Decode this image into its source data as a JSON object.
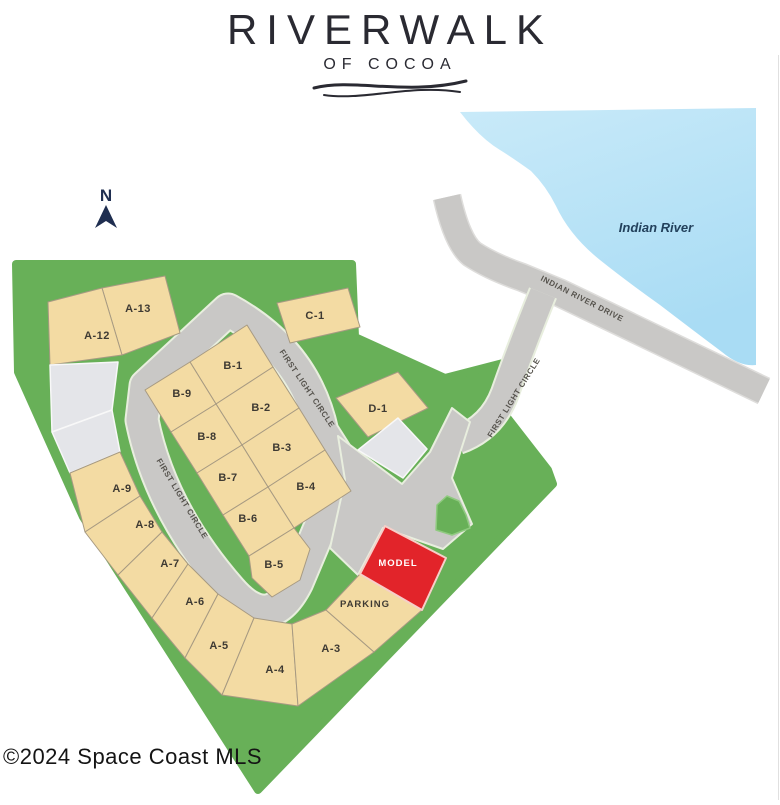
{
  "header": {
    "title": "RIVERWALK",
    "subtitle": "OF COCOA"
  },
  "compass": {
    "label": "N",
    "x": 106,
    "y": 201,
    "color": "#1f2e50"
  },
  "copyright": {
    "text": "©2024 Space Coast MLS"
  },
  "colors": {
    "water": "#a9dcf4",
    "water_light": "#c9eaf9",
    "green": "#68b058",
    "green_edge": "#8fca7f",
    "road": "#c9c8c6",
    "road_edge": "#e8eede",
    "ird_edge": "#dedddb",
    "lot_available": "#f3dba3",
    "lot_border": "#a79a82",
    "lot_unavailable": "#e4e5e9",
    "lot_unavailable_border": "#f8f8f8",
    "lot_model": "#e2242a",
    "lot_model_border": "#f6cfc9",
    "label_dark": "#3e3a33",
    "label_road": "#55524c",
    "label_water": "#23415c",
    "label_model": "#ffffff"
  },
  "water": {
    "label": "Indian River",
    "label_x": 656,
    "label_y": 232,
    "path": "M460,112 L756,108 L756,365 Q740,367 722,352 Q690,328 660,305 Q625,280 600,260 Q570,236 556,206 Q546,186 531,171 Q513,158 500,150 Q480,138 460,112 Z"
  },
  "site": {
    "points": [
      [
        16,
        264
      ],
      [
        352,
        264
      ],
      [
        355,
        337
      ],
      [
        445,
        378
      ],
      [
        503,
        363
      ],
      [
        492,
        398
      ],
      [
        548,
        470
      ],
      [
        553,
        484
      ],
      [
        258,
        790
      ],
      [
        83,
        517
      ],
      [
        18,
        372
      ]
    ],
    "tab_points": [
      [
        436,
        530
      ],
      [
        437,
        505
      ],
      [
        447,
        496
      ],
      [
        459,
        501
      ],
      [
        466,
        515
      ],
      [
        470,
        528
      ],
      [
        452,
        535
      ]
    ]
  },
  "roads": {
    "indian_river_drive": {
      "name": "INDIAN RIVER DRIVE",
      "path": "M447,197 Q457,242 472,254 Q492,267 521,277 L560,293 L764,391",
      "width": 26
    },
    "connector": {
      "name": "FIRST LIGHT CIRCLE",
      "path": "M543,293 Q520,350 505,393 Q492,428 458,440",
      "width": 26
    },
    "loop": {
      "name": "FIRST LIGHT CIRCLE",
      "path": "M228,310 Q305,352 322,432 L345,468 L297,582 Q270,636 230,590 Q160,510 142,420 L146,386 Z",
      "width": 31
    },
    "entrance_points": [
      [
        338,
        436
      ],
      [
        402,
        484
      ],
      [
        430,
        452
      ],
      [
        452,
        408
      ],
      [
        470,
        422
      ],
      [
        452,
        478
      ],
      [
        472,
        524
      ],
      [
        443,
        549
      ],
      [
        383,
        528
      ],
      [
        358,
        575
      ],
      [
        330,
        548
      ],
      [
        345,
        480
      ]
    ],
    "labels": [
      {
        "text": "FIRST LIGHT CIRCLE",
        "x": 305,
        "y": 390,
        "rot": 56
      },
      {
        "text": "FIRST LIGHT CIRCLE",
        "x": 180,
        "y": 500,
        "rot": 59
      },
      {
        "text": "FIRST LIGHT CIRCLE",
        "x": 516,
        "y": 399,
        "rot": -58
      },
      {
        "text": "INDIAN RIVER DRIVE",
        "x": 581,
        "y": 301,
        "rot": 27
      }
    ]
  },
  "lots": [
    {
      "id": "A-13",
      "label": "A-13",
      "type": "available",
      "points": [
        [
          102,
          288
        ],
        [
          165,
          276
        ],
        [
          180,
          333
        ],
        [
          122,
          355
        ]
      ],
      "lx": 138,
      "ly": 312
    },
    {
      "id": "A-12",
      "label": "A-12",
      "type": "available",
      "points": [
        [
          48,
          302
        ],
        [
          102,
          288
        ],
        [
          122,
          355
        ],
        [
          50,
          365
        ]
      ],
      "lx": 97,
      "ly": 339
    },
    {
      "id": "g1",
      "label": "",
      "type": "unavailable",
      "points": [
        [
          50,
          365
        ],
        [
          118,
          362
        ],
        [
          112,
          410
        ],
        [
          52,
          432
        ]
      ],
      "lx": 0,
      "ly": 0
    },
    {
      "id": "g2",
      "label": "",
      "type": "unavailable",
      "points": [
        [
          52,
          432
        ],
        [
          112,
          410
        ],
        [
          120,
          452
        ],
        [
          70,
          473
        ]
      ],
      "lx": 0,
      "ly": 0
    },
    {
      "id": "A-9",
      "label": "A-9",
      "type": "available",
      "points": [
        [
          70,
          473
        ],
        [
          120,
          452
        ],
        [
          140,
          496
        ],
        [
          85,
          532
        ]
      ],
      "lx": 122,
      "ly": 492
    },
    {
      "id": "A-8",
      "label": "A-8",
      "type": "available",
      "points": [
        [
          85,
          532
        ],
        [
          140,
          496
        ],
        [
          162,
          532
        ],
        [
          118,
          575
        ]
      ],
      "lx": 145,
      "ly": 528
    },
    {
      "id": "A-7",
      "label": "A-7",
      "type": "available",
      "points": [
        [
          118,
          575
        ],
        [
          162,
          532
        ],
        [
          188,
          564
        ],
        [
          152,
          618
        ]
      ],
      "lx": 170,
      "ly": 567
    },
    {
      "id": "A-6",
      "label": "A-6",
      "type": "available",
      "points": [
        [
          152,
          618
        ],
        [
          188,
          564
        ],
        [
          218,
          594
        ],
        [
          185,
          658
        ]
      ],
      "lx": 195,
      "ly": 605
    },
    {
      "id": "A-5",
      "label": "A-5",
      "type": "available",
      "points": [
        [
          185,
          658
        ],
        [
          218,
          594
        ],
        [
          254,
          618
        ],
        [
          222,
          695
        ]
      ],
      "lx": 219,
      "ly": 649
    },
    {
      "id": "A-4",
      "label": "A-4",
      "type": "available",
      "points": [
        [
          222,
          695
        ],
        [
          254,
          618
        ],
        [
          292,
          624
        ],
        [
          298,
          706
        ]
      ],
      "lx": 275,
      "ly": 673
    },
    {
      "id": "A-3",
      "label": "A-3",
      "type": "available",
      "points": [
        [
          292,
          624
        ],
        [
          326,
          610
        ],
        [
          374,
          652
        ],
        [
          298,
          706
        ]
      ],
      "lx": 331,
      "ly": 652
    },
    {
      "id": "parking",
      "label": "PARKING",
      "type": "parking",
      "points": [
        [
          326,
          610
        ],
        [
          360,
          574
        ],
        [
          422,
          610
        ],
        [
          374,
          652
        ]
      ],
      "lx": 365,
      "ly": 607
    },
    {
      "id": "model",
      "label": "MODEL",
      "type": "model",
      "points": [
        [
          360,
          574
        ],
        [
          385,
          526
        ],
        [
          446,
          558
        ],
        [
          422,
          610
        ]
      ],
      "lx": 398,
      "ly": 566
    },
    {
      "id": "B-1",
      "label": "B-1",
      "type": "available",
      "points": [
        [
          247,
          325
        ],
        [
          273,
          367
        ],
        [
          216,
          404
        ],
        [
          190,
          362
        ]
      ],
      "lx": 233,
      "ly": 369
    },
    {
      "id": "B-2",
      "label": "B-2",
      "type": "available",
      "points": [
        [
          273,
          367
        ],
        [
          299,
          408
        ],
        [
          242,
          445
        ],
        [
          216,
          404
        ]
      ],
      "lx": 261,
      "ly": 411
    },
    {
      "id": "B-3",
      "label": "B-3",
      "type": "available",
      "points": [
        [
          299,
          408
        ],
        [
          325,
          450
        ],
        [
          268,
          487
        ],
        [
          242,
          445
        ]
      ],
      "lx": 282,
      "ly": 451
    },
    {
      "id": "B-4",
      "label": "B-4",
      "type": "available",
      "points": [
        [
          325,
          450
        ],
        [
          351,
          491
        ],
        [
          294,
          528
        ],
        [
          268,
          487
        ]
      ],
      "lx": 306,
      "ly": 490
    },
    {
      "id": "B-9",
      "label": "B-9",
      "type": "available",
      "points": [
        [
          190,
          362
        ],
        [
          216,
          404
        ],
        [
          171,
          432
        ],
        [
          145,
          390
        ]
      ],
      "lx": 182,
      "ly": 397
    },
    {
      "id": "B-8",
      "label": "B-8",
      "type": "available",
      "points": [
        [
          216,
          404
        ],
        [
          242,
          445
        ],
        [
          197,
          473
        ],
        [
          171,
          432
        ]
      ],
      "lx": 207,
      "ly": 440
    },
    {
      "id": "B-7",
      "label": "B-7",
      "type": "available",
      "points": [
        [
          242,
          445
        ],
        [
          268,
          487
        ],
        [
          223,
          515
        ],
        [
          197,
          473
        ]
      ],
      "lx": 228,
      "ly": 481
    },
    {
      "id": "B-6",
      "label": "B-6",
      "type": "available",
      "points": [
        [
          268,
          487
        ],
        [
          294,
          528
        ],
        [
          249,
          556
        ],
        [
          223,
          515
        ]
      ],
      "lx": 248,
      "ly": 522
    },
    {
      "id": "B-5",
      "label": "B-5",
      "type": "available",
      "points": [
        [
          249,
          556
        ],
        [
          294,
          528
        ],
        [
          310,
          549
        ],
        [
          300,
          580
        ],
        [
          272,
          597
        ],
        [
          252,
          578
        ]
      ],
      "lx": 274,
      "ly": 568
    },
    {
      "id": "C-1",
      "label": "C-1",
      "type": "available",
      "points": [
        [
          277,
          303
        ],
        [
          348,
          288
        ],
        [
          360,
          327
        ],
        [
          290,
          343
        ]
      ],
      "lx": 315,
      "ly": 319
    },
    {
      "id": "D-1",
      "label": "D-1",
      "type": "available",
      "points": [
        [
          336,
          398
        ],
        [
          398,
          372
        ],
        [
          428,
          408
        ],
        [
          368,
          437
        ]
      ],
      "lx": 378,
      "ly": 412
    },
    {
      "id": "d-gray",
      "label": "",
      "type": "unavailable",
      "points": [
        [
          398,
          418
        ],
        [
          427,
          449
        ],
        [
          403,
          478
        ],
        [
          358,
          450
        ]
      ],
      "lx": 0,
      "ly": 0
    }
  ]
}
